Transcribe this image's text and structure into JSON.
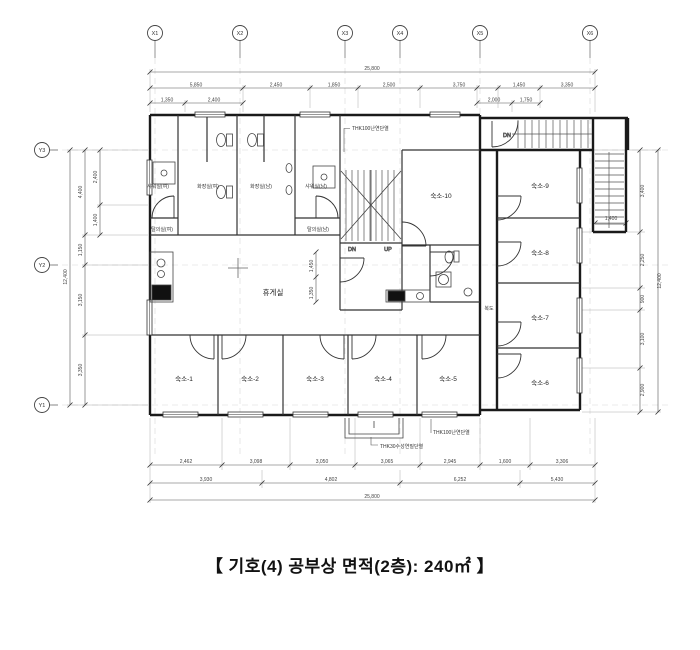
{
  "caption": "【 기호(4) 공부상 면적(2층): 240㎡ 】",
  "grid": {
    "top": [
      "X1",
      "X2",
      "X3",
      "X4",
      "X5",
      "X6"
    ],
    "left": [
      "Y3",
      "Y2",
      "Y1"
    ]
  },
  "rooms": {
    "bottom": [
      "숙소-1",
      "숙소-2",
      "숙소-3",
      "숙소-4",
      "숙소-5"
    ],
    "right": [
      "숙소-9",
      "숙소-8",
      "숙소-7",
      "숙소-6"
    ],
    "center": "숙소-10",
    "lounge": "휴게실",
    "corridor": "복도",
    "shower_w": "샤워실(여)",
    "toilet_w": "화장실(여)",
    "toilet_m": "화장실(남)",
    "shower_m": "샤워실(남)",
    "dressing_w": "탈의실(여)",
    "dressing_m": "탈의실(남)"
  },
  "stair": {
    "dn": "DN",
    "up": "UP",
    "dn_top": "DN"
  },
  "annotations": {
    "insulation_top": "THK100난연단열",
    "insulation_bottom": "THK100난연단열",
    "finish_bottom": "THK30수성연질단열"
  },
  "dims": {
    "top_overall": "25,800",
    "top_row": [
      "5,850",
      "2,450",
      "1,850",
      "2,500",
      "3,750",
      "1,450",
      "3,350"
    ],
    "top_sub_left": [
      "1,350",
      "2,400"
    ],
    "top_sub_mid": [
      "2,000",
      "1,750"
    ],
    "bottom_row1": [
      "2,462",
      "3,098",
      "3,050",
      "3,065",
      "2,945",
      "1,600",
      "3,306"
    ],
    "bottom_row2": [
      "3,930",
      "4,802",
      "6,252",
      "5,430"
    ],
    "bottom_overall": "25,800",
    "left_overall": "12,400",
    "left_chain": [
      "4,400",
      "1,150",
      "3,150",
      "3,350"
    ],
    "left_sub": [
      "2,400",
      "1,400"
    ],
    "right_chain": [
      "3,400",
      "2,250",
      "900",
      "3,100",
      "2,900"
    ],
    "right_overall": "12,400",
    "stair_width": "1,400",
    "mini_v": [
      "1,450",
      "1,350"
    ]
  }
}
